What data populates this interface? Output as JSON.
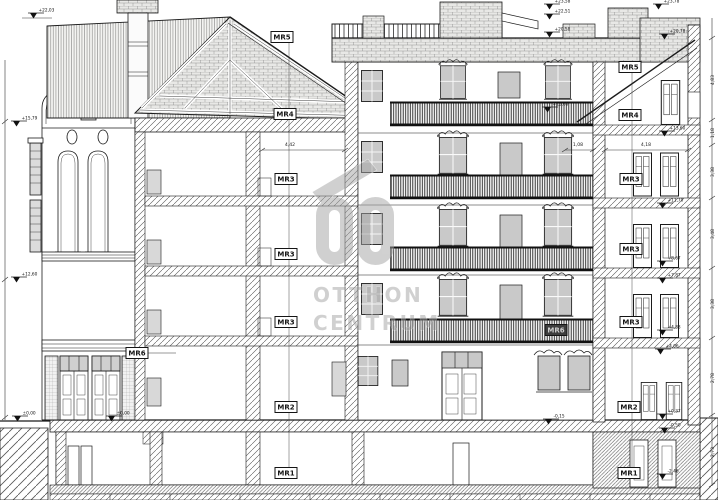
{
  "drawing": {
    "type": "building-section-elevation",
    "watermark": {
      "line1": "OTTHON",
      "line2": "CENTRUM"
    },
    "colors": {
      "line": "#1b1b1b",
      "glass": "#c9c9c9",
      "railing": "#161616",
      "brick_fill": "#e8e8e6",
      "watermark": "#a3a3a3",
      "paper": "#ffffff"
    },
    "room_labels": [
      {
        "text": "MR5",
        "x": 282,
        "y": 37,
        "inverted": false
      },
      {
        "text": "MR4",
        "x": 285,
        "y": 114,
        "inverted": false
      },
      {
        "text": "MR3",
        "x": 286,
        "y": 179,
        "inverted": false
      },
      {
        "text": "MR3",
        "x": 286,
        "y": 254,
        "inverted": false
      },
      {
        "text": "MR3",
        "x": 286,
        "y": 322,
        "inverted": false
      },
      {
        "text": "MR2",
        "x": 286,
        "y": 407,
        "inverted": false
      },
      {
        "text": "MR1",
        "x": 286,
        "y": 473,
        "inverted": false
      },
      {
        "text": "MR6",
        "x": 137,
        "y": 353,
        "inverted": false
      },
      {
        "text": "MR5",
        "x": 630,
        "y": 67,
        "inverted": false
      },
      {
        "text": "MR4",
        "x": 630,
        "y": 115,
        "inverted": false
      },
      {
        "text": "MR3",
        "x": 631,
        "y": 179,
        "inverted": false
      },
      {
        "text": "MR3",
        "x": 631,
        "y": 249,
        "inverted": false
      },
      {
        "text": "MR3",
        "x": 631,
        "y": 322,
        "inverted": false
      },
      {
        "text": "MR2",
        "x": 629,
        "y": 407,
        "inverted": false
      },
      {
        "text": "MR1",
        "x": 629,
        "y": 473,
        "inverted": false
      },
      {
        "text": "MR6",
        "x": 556,
        "y": 330,
        "inverted": true
      }
    ],
    "elevation_markers": [
      {
        "value": "+22,03",
        "x": 30,
        "y": 13
      },
      {
        "value": "+15,79",
        "x": 13,
        "y": 121
      },
      {
        "value": "+12,60",
        "x": 13,
        "y": 277
      },
      {
        "value": "±0,00",
        "x": 14,
        "y": 416
      },
      {
        "value": "±0,00",
        "x": 108,
        "y": 416
      },
      {
        "value": "+23,58",
        "x": 546,
        "y": 4
      },
      {
        "value": "+22,51",
        "x": 546,
        "y": 14
      },
      {
        "value": "+20,58",
        "x": 546,
        "y": 32
      },
      {
        "value": "+23,78",
        "x": 655,
        "y": 4
      },
      {
        "value": "+20,78",
        "x": 661,
        "y": 34
      },
      {
        "value": "+15,60",
        "x": 544,
        "y": 107
      },
      {
        "value": "+13,60",
        "x": 661,
        "y": 131
      },
      {
        "value": "+11,70",
        "x": 659,
        "y": 203
      },
      {
        "value": "+8,67",
        "x": 659,
        "y": 261
      },
      {
        "value": "+7,87",
        "x": 659,
        "y": 278
      },
      {
        "value": "+4,83",
        "x": 659,
        "y": 330
      },
      {
        "value": "+4,06",
        "x": 657,
        "y": 349
      },
      {
        "value": "-0,15",
        "x": 545,
        "y": 419
      },
      {
        "value": "+0,37",
        "x": 659,
        "y": 414
      },
      {
        "value": "-0,50",
        "x": 661,
        "y": 428
      },
      {
        "value": "-2,46",
        "x": 659,
        "y": 474
      }
    ],
    "dimension_labels": [
      {
        "value": "4,42",
        "x": 290,
        "y": 146,
        "rotated": false
      },
      {
        "value": "1,08",
        "x": 578,
        "y": 146,
        "rotated": false
      },
      {
        "value": "4,18",
        "x": 646,
        "y": 146,
        "rotated": false
      },
      {
        "value": "4,83",
        "x": 714,
        "y": 80,
        "rotated": true
      },
      {
        "value": "1,18",
        "x": 714,
        "y": 133,
        "rotated": true
      },
      {
        "value": "3,38",
        "x": 714,
        "y": 172,
        "rotated": true
      },
      {
        "value": "3,48",
        "x": 714,
        "y": 234,
        "rotated": true
      },
      {
        "value": "3,38",
        "x": 714,
        "y": 304,
        "rotated": true
      },
      {
        "value": "2,78",
        "x": 714,
        "y": 378,
        "rotated": true
      },
      {
        "value": "2,73",
        "x": 714,
        "y": 452,
        "rotated": true
      }
    ]
  }
}
